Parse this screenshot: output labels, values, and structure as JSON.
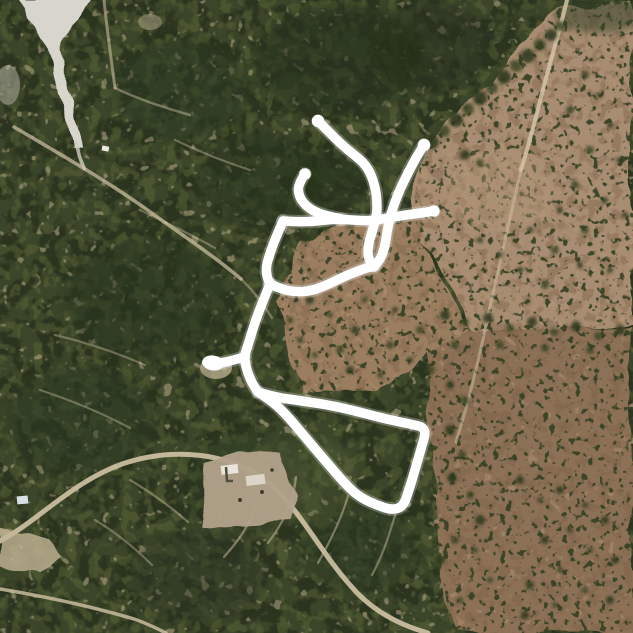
{
  "map": {
    "type": "satellite-aerial",
    "scene": "Aerial imagery of a wooded rural subdivision beside open brown fields, with a white hand-drawn route overlay",
    "palette": {
      "vegetation_dark": "#3b4529",
      "vegetation_shadow": "#262f1b",
      "vegetation_light": "#5c6639",
      "field_pink_tan": "#a98d72",
      "field_brown": "#8d7156",
      "field_center_patch": "#9b7e61",
      "road_tan": "#d2c3a6",
      "creek_pale": "#d7d5cc",
      "building_pad": "#b4a38c",
      "route_white": "#ffffff"
    },
    "route": {
      "color": "#ffffff",
      "stroke_width": 9.5,
      "glow_width": 13.5,
      "glow_opacity": 0.25,
      "segments": [
        {
          "name": "north-arm-through-u-to-northeast-arm",
          "points": [
            [
              318,
              121
            ],
            [
              328,
              131
            ],
            [
              341,
              144
            ],
            [
              353,
              154
            ],
            [
              363,
              162
            ],
            [
              370,
              172
            ],
            [
              375,
              186
            ],
            [
              377,
              200
            ],
            [
              377,
              214
            ],
            [
              373,
              229
            ],
            [
              368,
              245
            ],
            [
              368,
              258
            ],
            [
              374,
              267
            ],
            [
              381,
              258
            ],
            [
              385,
              246
            ],
            [
              387,
              232
            ],
            [
              390,
              217
            ],
            [
              395,
              202
            ],
            [
              401,
              187
            ],
            [
              409,
              171
            ],
            [
              417,
              156
            ],
            [
              424,
              145
            ]
          ]
        },
        {
          "name": "cross-spur-east",
          "points": [
            [
              283,
              221
            ],
            [
              300,
              222
            ],
            [
              318,
              221
            ],
            [
              335,
              219
            ],
            [
              352,
              220
            ],
            [
              370,
              221
            ],
            [
              388,
              218
            ],
            [
              406,
              215
            ],
            [
              421,
              213
            ],
            [
              434,
              211
            ]
          ]
        },
        {
          "name": "middle-hook",
          "points": [
            [
              305,
              174
            ],
            [
              299,
              183
            ],
            [
              298,
              193
            ],
            [
              303,
              203
            ],
            [
              313,
              211
            ],
            [
              327,
              216
            ],
            [
              342,
              219
            ]
          ]
        },
        {
          "name": "elbow-drop",
          "points": [
            [
              283,
              221
            ],
            [
              276,
              237
            ],
            [
              270,
              253
            ],
            [
              266,
              267
            ],
            [
              267,
              277
            ],
            [
              270,
              284
            ]
          ]
        },
        {
          "name": "dip-connector",
          "points": [
            [
              270,
              284
            ],
            [
              281,
              289
            ],
            [
              295,
              292
            ],
            [
              311,
              291
            ],
            [
              327,
              285
            ],
            [
              343,
              277
            ],
            [
              358,
              271
            ],
            [
              369,
              267
            ],
            [
              374,
              267
            ]
          ]
        },
        {
          "name": "main-descent",
          "points": [
            [
              270,
              284
            ],
            [
              263,
              301
            ],
            [
              255,
              322
            ],
            [
              249,
              342
            ],
            [
              244,
              357
            ],
            [
              247,
              371
            ],
            [
              252,
              383
            ],
            [
              258,
              392
            ]
          ]
        },
        {
          "name": "west-stub",
          "points": [
            [
              244,
              357
            ],
            [
              234,
              360
            ],
            [
              222,
              363
            ],
            [
              212,
              363
            ]
          ]
        },
        {
          "name": "south-loop",
          "points": [
            [
              258,
              392
            ],
            [
              275,
              397
            ],
            [
              295,
              400
            ],
            [
              316,
              403
            ],
            [
              339,
              407
            ],
            [
              363,
              413
            ],
            [
              386,
              419
            ],
            [
              410,
              424
            ],
            [
              427,
              428
            ],
            [
              421,
              449
            ],
            [
              415,
              470
            ],
            [
              409,
              490
            ],
            [
              403,
              507
            ],
            [
              391,
              510
            ],
            [
              377,
              505
            ],
            [
              363,
              499
            ],
            [
              350,
              489
            ],
            [
              334,
              471
            ],
            [
              317,
              451
            ],
            [
              300,
              431
            ],
            [
              284,
              412
            ],
            [
              270,
              400
            ],
            [
              258,
              392
            ]
          ]
        }
      ],
      "endpoints": [
        {
          "name": "north-arm-end",
          "x": 318,
          "y": 121,
          "r": 6.2
        },
        {
          "name": "northeast-arm-end",
          "x": 424,
          "y": 145,
          "r": 6.2
        },
        {
          "name": "east-spur-end",
          "x": 434,
          "y": 211,
          "r": 5.6
        },
        {
          "name": "middle-hook-end",
          "x": 305,
          "y": 174,
          "r": 5.8
        }
      ],
      "blob_endpoint": {
        "name": "west-blob-end",
        "x": 213,
        "y": 363,
        "rx": 11,
        "ry": 7.5,
        "rotate": 8
      }
    }
  }
}
